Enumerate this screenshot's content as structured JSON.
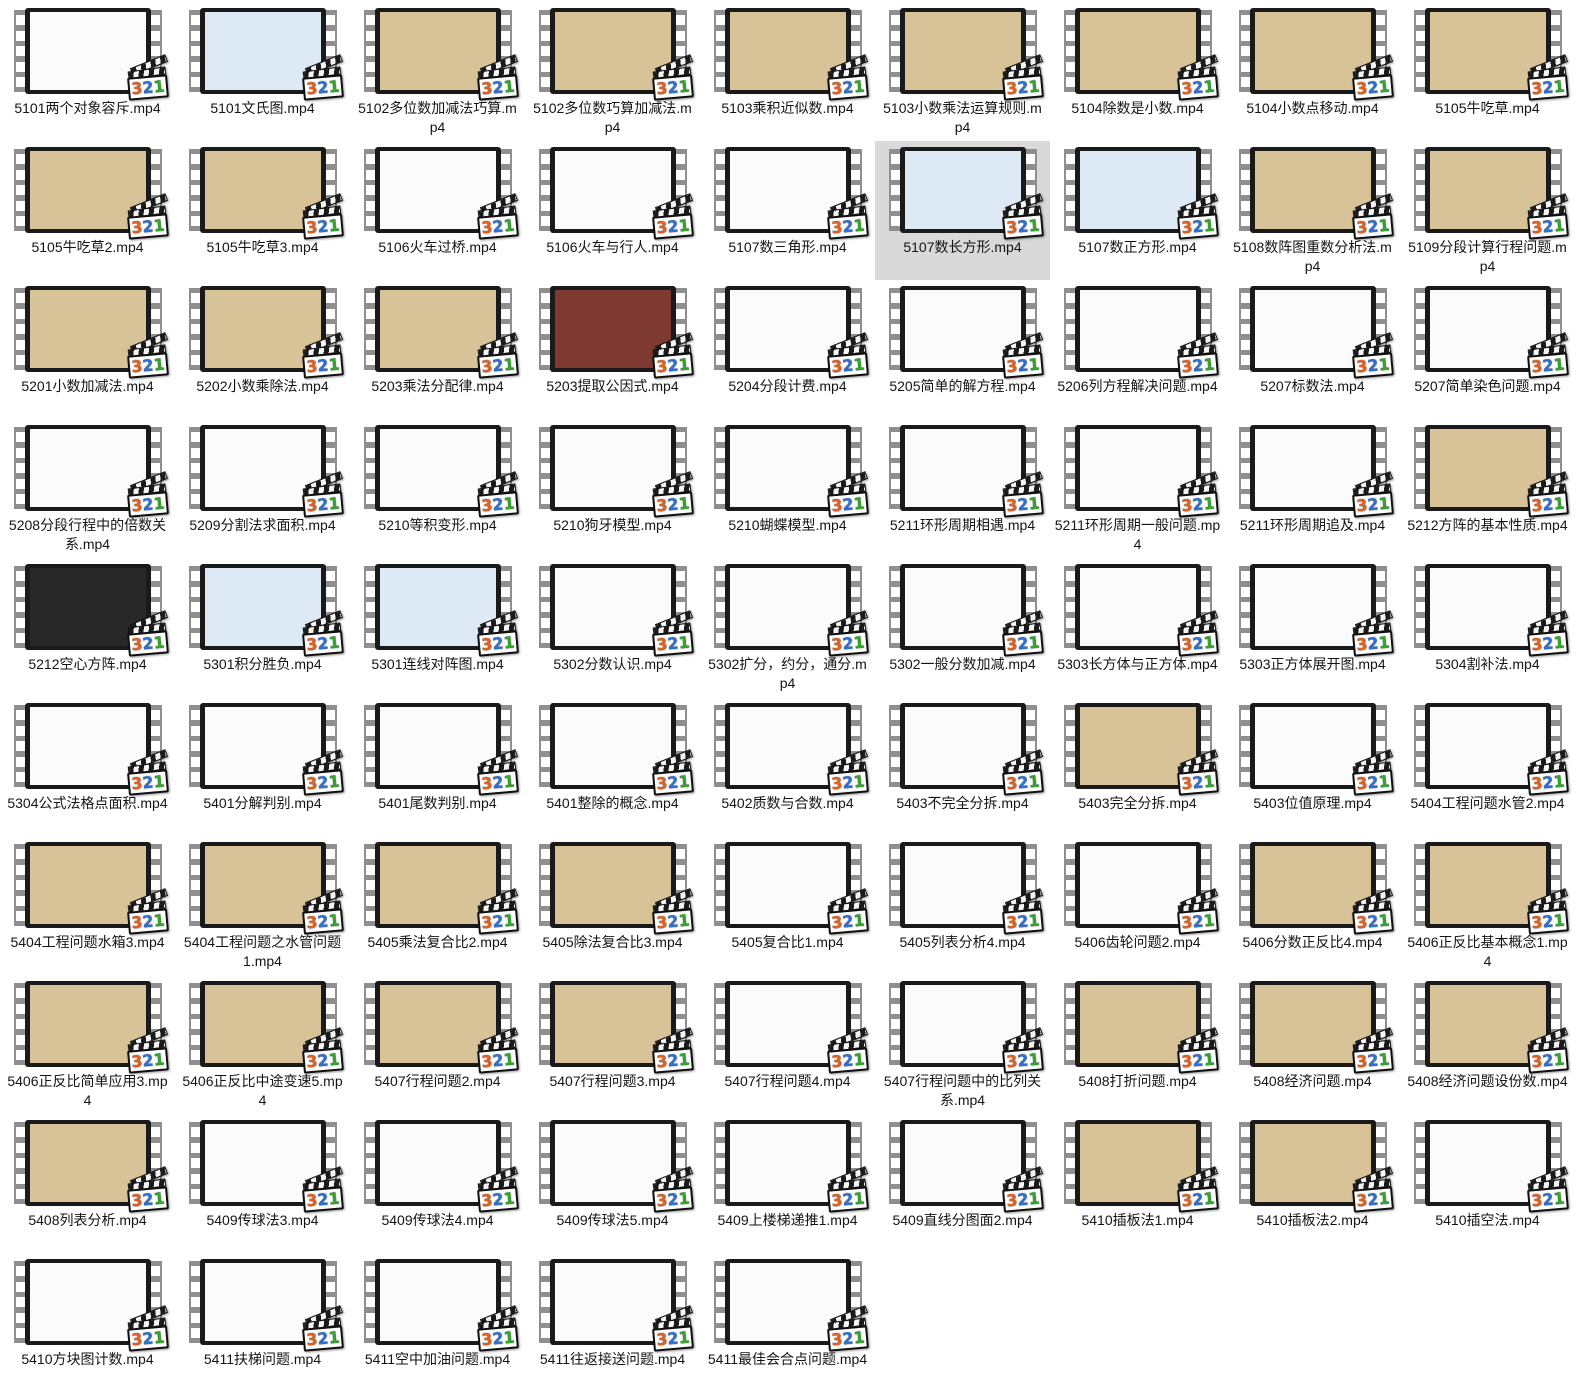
{
  "view": {
    "type": "file-explorer-video-thumbnails",
    "columns": 9,
    "selected_file": "5107数长方形.mp4",
    "selection_color": "#d9d9d9"
  },
  "player_badge": {
    "name": "media-player-classic-321",
    "digits": [
      {
        "text": "3",
        "color": "#e2611e"
      },
      {
        "text": "2",
        "color": "#2e6fd2"
      },
      {
        "text": "1",
        "color": "#33a42c"
      }
    ]
  },
  "thumb_colors": {
    "tan": "#d8c297",
    "white": "#fbfbfb",
    "blue": "#dcead6",
    "lightblue": "#dde9f5",
    "dark": "#282828",
    "maroon": "#7e3a31"
  },
  "items": [
    {
      "filename": "5101两个对象容斥.mp4",
      "thumb": "white"
    },
    {
      "filename": "5101文氏图.mp4",
      "thumb": "lightblue"
    },
    {
      "filename": "5102多位数加减法巧算.mp4",
      "thumb": "tan"
    },
    {
      "filename": "5102多位数巧算加减法.mp4",
      "thumb": "tan"
    },
    {
      "filename": "5103乘积近似数.mp4",
      "thumb": "tan"
    },
    {
      "filename": "5103小数乘法运算规则.mp4",
      "thumb": "tan"
    },
    {
      "filename": "5104除数是小数.mp4",
      "thumb": "tan"
    },
    {
      "filename": "5104小数点移动.mp4",
      "thumb": "tan"
    },
    {
      "filename": "5105牛吃草.mp4",
      "thumb": "tan"
    },
    {
      "filename": "5105牛吃草2.mp4",
      "thumb": "tan"
    },
    {
      "filename": "5105牛吃草3.mp4",
      "thumb": "tan"
    },
    {
      "filename": "5106火车过桥.mp4",
      "thumb": "white"
    },
    {
      "filename": "5106火车与行人.mp4",
      "thumb": "white"
    },
    {
      "filename": "5107数三角形.mp4",
      "thumb": "white"
    },
    {
      "filename": "5107数长方形.mp4",
      "thumb": "lightblue",
      "selected": true
    },
    {
      "filename": "5107数正方形.mp4",
      "thumb": "lightblue"
    },
    {
      "filename": "5108数阵图重数分析法.mp4",
      "thumb": "tan"
    },
    {
      "filename": "5109分段计算行程问题.mp4",
      "thumb": "tan"
    },
    {
      "filename": "5201小数加减法.mp4",
      "thumb": "tan"
    },
    {
      "filename": "5202小数乘除法.mp4",
      "thumb": "tan"
    },
    {
      "filename": "5203乘法分配律.mp4",
      "thumb": "tan"
    },
    {
      "filename": "5203提取公因式.mp4",
      "thumb": "maroon"
    },
    {
      "filename": "5204分段计费.mp4",
      "thumb": "white"
    },
    {
      "filename": "5205简单的解方程.mp4",
      "thumb": "white"
    },
    {
      "filename": "5206列方程解决问题.mp4",
      "thumb": "white"
    },
    {
      "filename": "5207标数法.mp4",
      "thumb": "white"
    },
    {
      "filename": "5207简单染色问题.mp4",
      "thumb": "white"
    },
    {
      "filename": "5208分段行程中的倍数关系.mp4",
      "thumb": "white"
    },
    {
      "filename": "5209分割法求面积.mp4",
      "thumb": "white"
    },
    {
      "filename": "5210等积变形.mp4",
      "thumb": "white"
    },
    {
      "filename": "5210狗牙模型.mp4",
      "thumb": "white"
    },
    {
      "filename": "5210蝴蝶模型.mp4",
      "thumb": "white"
    },
    {
      "filename": "5211环形周期相遇.mp4",
      "thumb": "white"
    },
    {
      "filename": "5211环形周期一般问题.mp4",
      "thumb": "white"
    },
    {
      "filename": "5211环形周期追及.mp4",
      "thumb": "white"
    },
    {
      "filename": "5212方阵的基本性质.mp4",
      "thumb": "tan"
    },
    {
      "filename": "5212空心方阵.mp4",
      "thumb": "dark"
    },
    {
      "filename": "5301积分胜负.mp4",
      "thumb": "lightblue"
    },
    {
      "filename": "5301连线对阵图.mp4",
      "thumb": "lightblue"
    },
    {
      "filename": "5302分数认识.mp4",
      "thumb": "white"
    },
    {
      "filename": "5302扩分，约分，通分.mp4",
      "thumb": "white"
    },
    {
      "filename": "5302一般分数加减.mp4",
      "thumb": "white"
    },
    {
      "filename": "5303长方体与正方体.mp4",
      "thumb": "white"
    },
    {
      "filename": "5303正方体展开图.mp4",
      "thumb": "white"
    },
    {
      "filename": "5304割补法.mp4",
      "thumb": "white"
    },
    {
      "filename": "5304公式法格点面积.mp4",
      "thumb": "white"
    },
    {
      "filename": "5401分解判别.mp4",
      "thumb": "white"
    },
    {
      "filename": "5401尾数判别.mp4",
      "thumb": "white"
    },
    {
      "filename": "5401整除的概念.mp4",
      "thumb": "white"
    },
    {
      "filename": "5402质数与合数.mp4",
      "thumb": "white"
    },
    {
      "filename": "5403不完全分拆.mp4",
      "thumb": "white"
    },
    {
      "filename": "5403完全分拆.mp4",
      "thumb": "tan"
    },
    {
      "filename": "5403位值原理.mp4",
      "thumb": "white"
    },
    {
      "filename": "5404工程问题水管2.mp4",
      "thumb": "white"
    },
    {
      "filename": "5404工程问题水箱3.mp4",
      "thumb": "tan"
    },
    {
      "filename": "5404工程问题之水管问题1.mp4",
      "thumb": "tan"
    },
    {
      "filename": "5405乘法复合比2.mp4",
      "thumb": "tan"
    },
    {
      "filename": "5405除法复合比3.mp4",
      "thumb": "tan"
    },
    {
      "filename": "5405复合比1.mp4",
      "thumb": "white"
    },
    {
      "filename": "5405列表分析4.mp4",
      "thumb": "white"
    },
    {
      "filename": "5406齿轮问题2.mp4",
      "thumb": "white"
    },
    {
      "filename": "5406分数正反比4.mp4",
      "thumb": "tan"
    },
    {
      "filename": "5406正反比基本概念1.mp4",
      "thumb": "tan"
    },
    {
      "filename": "5406正反比简单应用3.mp4",
      "thumb": "tan"
    },
    {
      "filename": "5406正反比中途变速5.mp4",
      "thumb": "tan"
    },
    {
      "filename": "5407行程问题2.mp4",
      "thumb": "tan"
    },
    {
      "filename": "5407行程问题3.mp4",
      "thumb": "tan"
    },
    {
      "filename": "5407行程问题4.mp4",
      "thumb": "white"
    },
    {
      "filename": "5407行程问题中的比列关系.mp4",
      "thumb": "white"
    },
    {
      "filename": "5408打折问题.mp4",
      "thumb": "tan"
    },
    {
      "filename": "5408经济问题.mp4",
      "thumb": "tan"
    },
    {
      "filename": "5408经济问题设份数.mp4",
      "thumb": "tan"
    },
    {
      "filename": "5408列表分析.mp4",
      "thumb": "tan"
    },
    {
      "filename": "5409传球法3.mp4",
      "thumb": "white"
    },
    {
      "filename": "5409传球法4.mp4",
      "thumb": "white"
    },
    {
      "filename": "5409传球法5.mp4",
      "thumb": "white"
    },
    {
      "filename": "5409上楼梯递推1.mp4",
      "thumb": "white"
    },
    {
      "filename": "5409直线分图面2.mp4",
      "thumb": "white"
    },
    {
      "filename": "5410插板法1.mp4",
      "thumb": "tan"
    },
    {
      "filename": "5410插板法2.mp4",
      "thumb": "tan"
    },
    {
      "filename": "5410插空法.mp4",
      "thumb": "white"
    },
    {
      "filename": "5410方块图计数.mp4",
      "thumb": "white"
    },
    {
      "filename": "5411扶梯问题.mp4",
      "thumb": "white"
    },
    {
      "filename": "5411空中加油问题.mp4",
      "thumb": "white"
    },
    {
      "filename": "5411往返接送问题.mp4",
      "thumb": "white"
    },
    {
      "filename": "5411最佳会合点问题.mp4",
      "thumb": "white"
    }
  ]
}
